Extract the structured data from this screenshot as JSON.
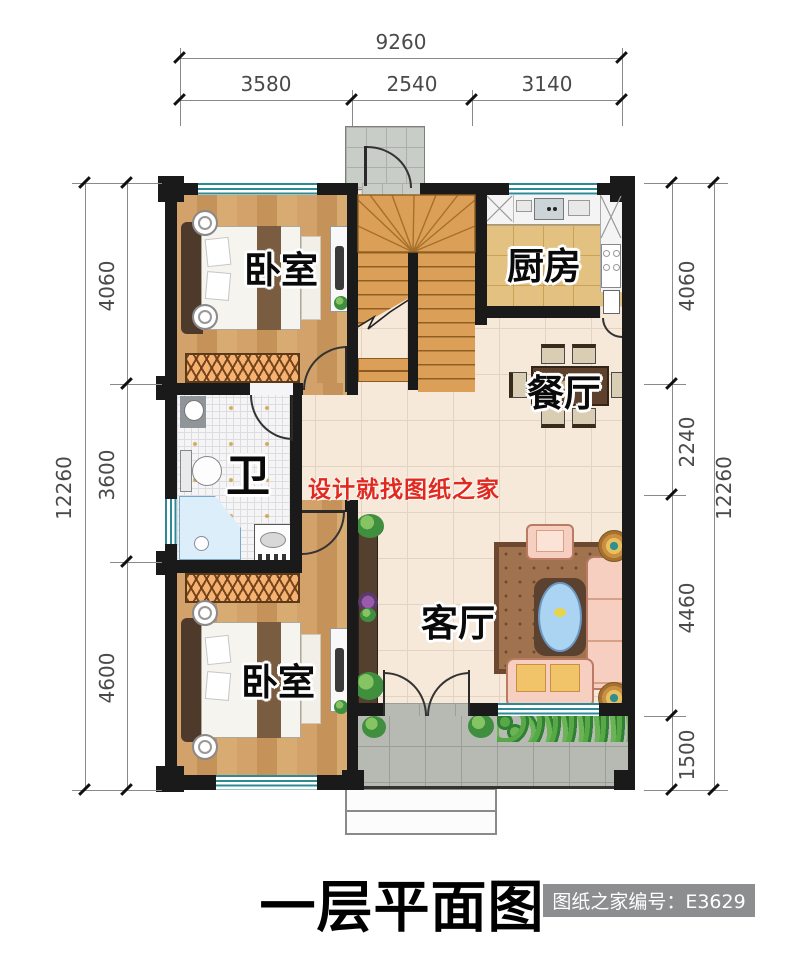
{
  "plan": {
    "title": "一层平面图",
    "stamp": "图纸之家编号：E3629",
    "watermark": "设计就找图纸之家",
    "rooms": {
      "bedroom_top": "卧室",
      "kitchen": "厨房",
      "dining": "餐厅",
      "bathroom": "卫",
      "living": "客厅",
      "bedroom_bottom": "卧室"
    },
    "dimensions": {
      "top": {
        "total": "9260",
        "segments": [
          "3580",
          "2540",
          "3140"
        ]
      },
      "left": {
        "total": "12260",
        "segments": [
          "4060",
          "3600",
          "4600"
        ]
      },
      "right": {
        "total": "12260",
        "segments": [
          "4060",
          "2240",
          "4460",
          "1500"
        ]
      }
    },
    "colors": {
      "wall": "#1a1a1a",
      "window_teal": "#2e8b95",
      "wood_floor": "#cf9e66",
      "stair_wood": "#dc9f58",
      "kitchen_tile": "#e3c180",
      "hall_tile": "#f6e9da",
      "porch_tile": "#b6bab3",
      "watermark_red": "#e02a20",
      "stamp_bg": "#8d8e8f"
    }
  }
}
